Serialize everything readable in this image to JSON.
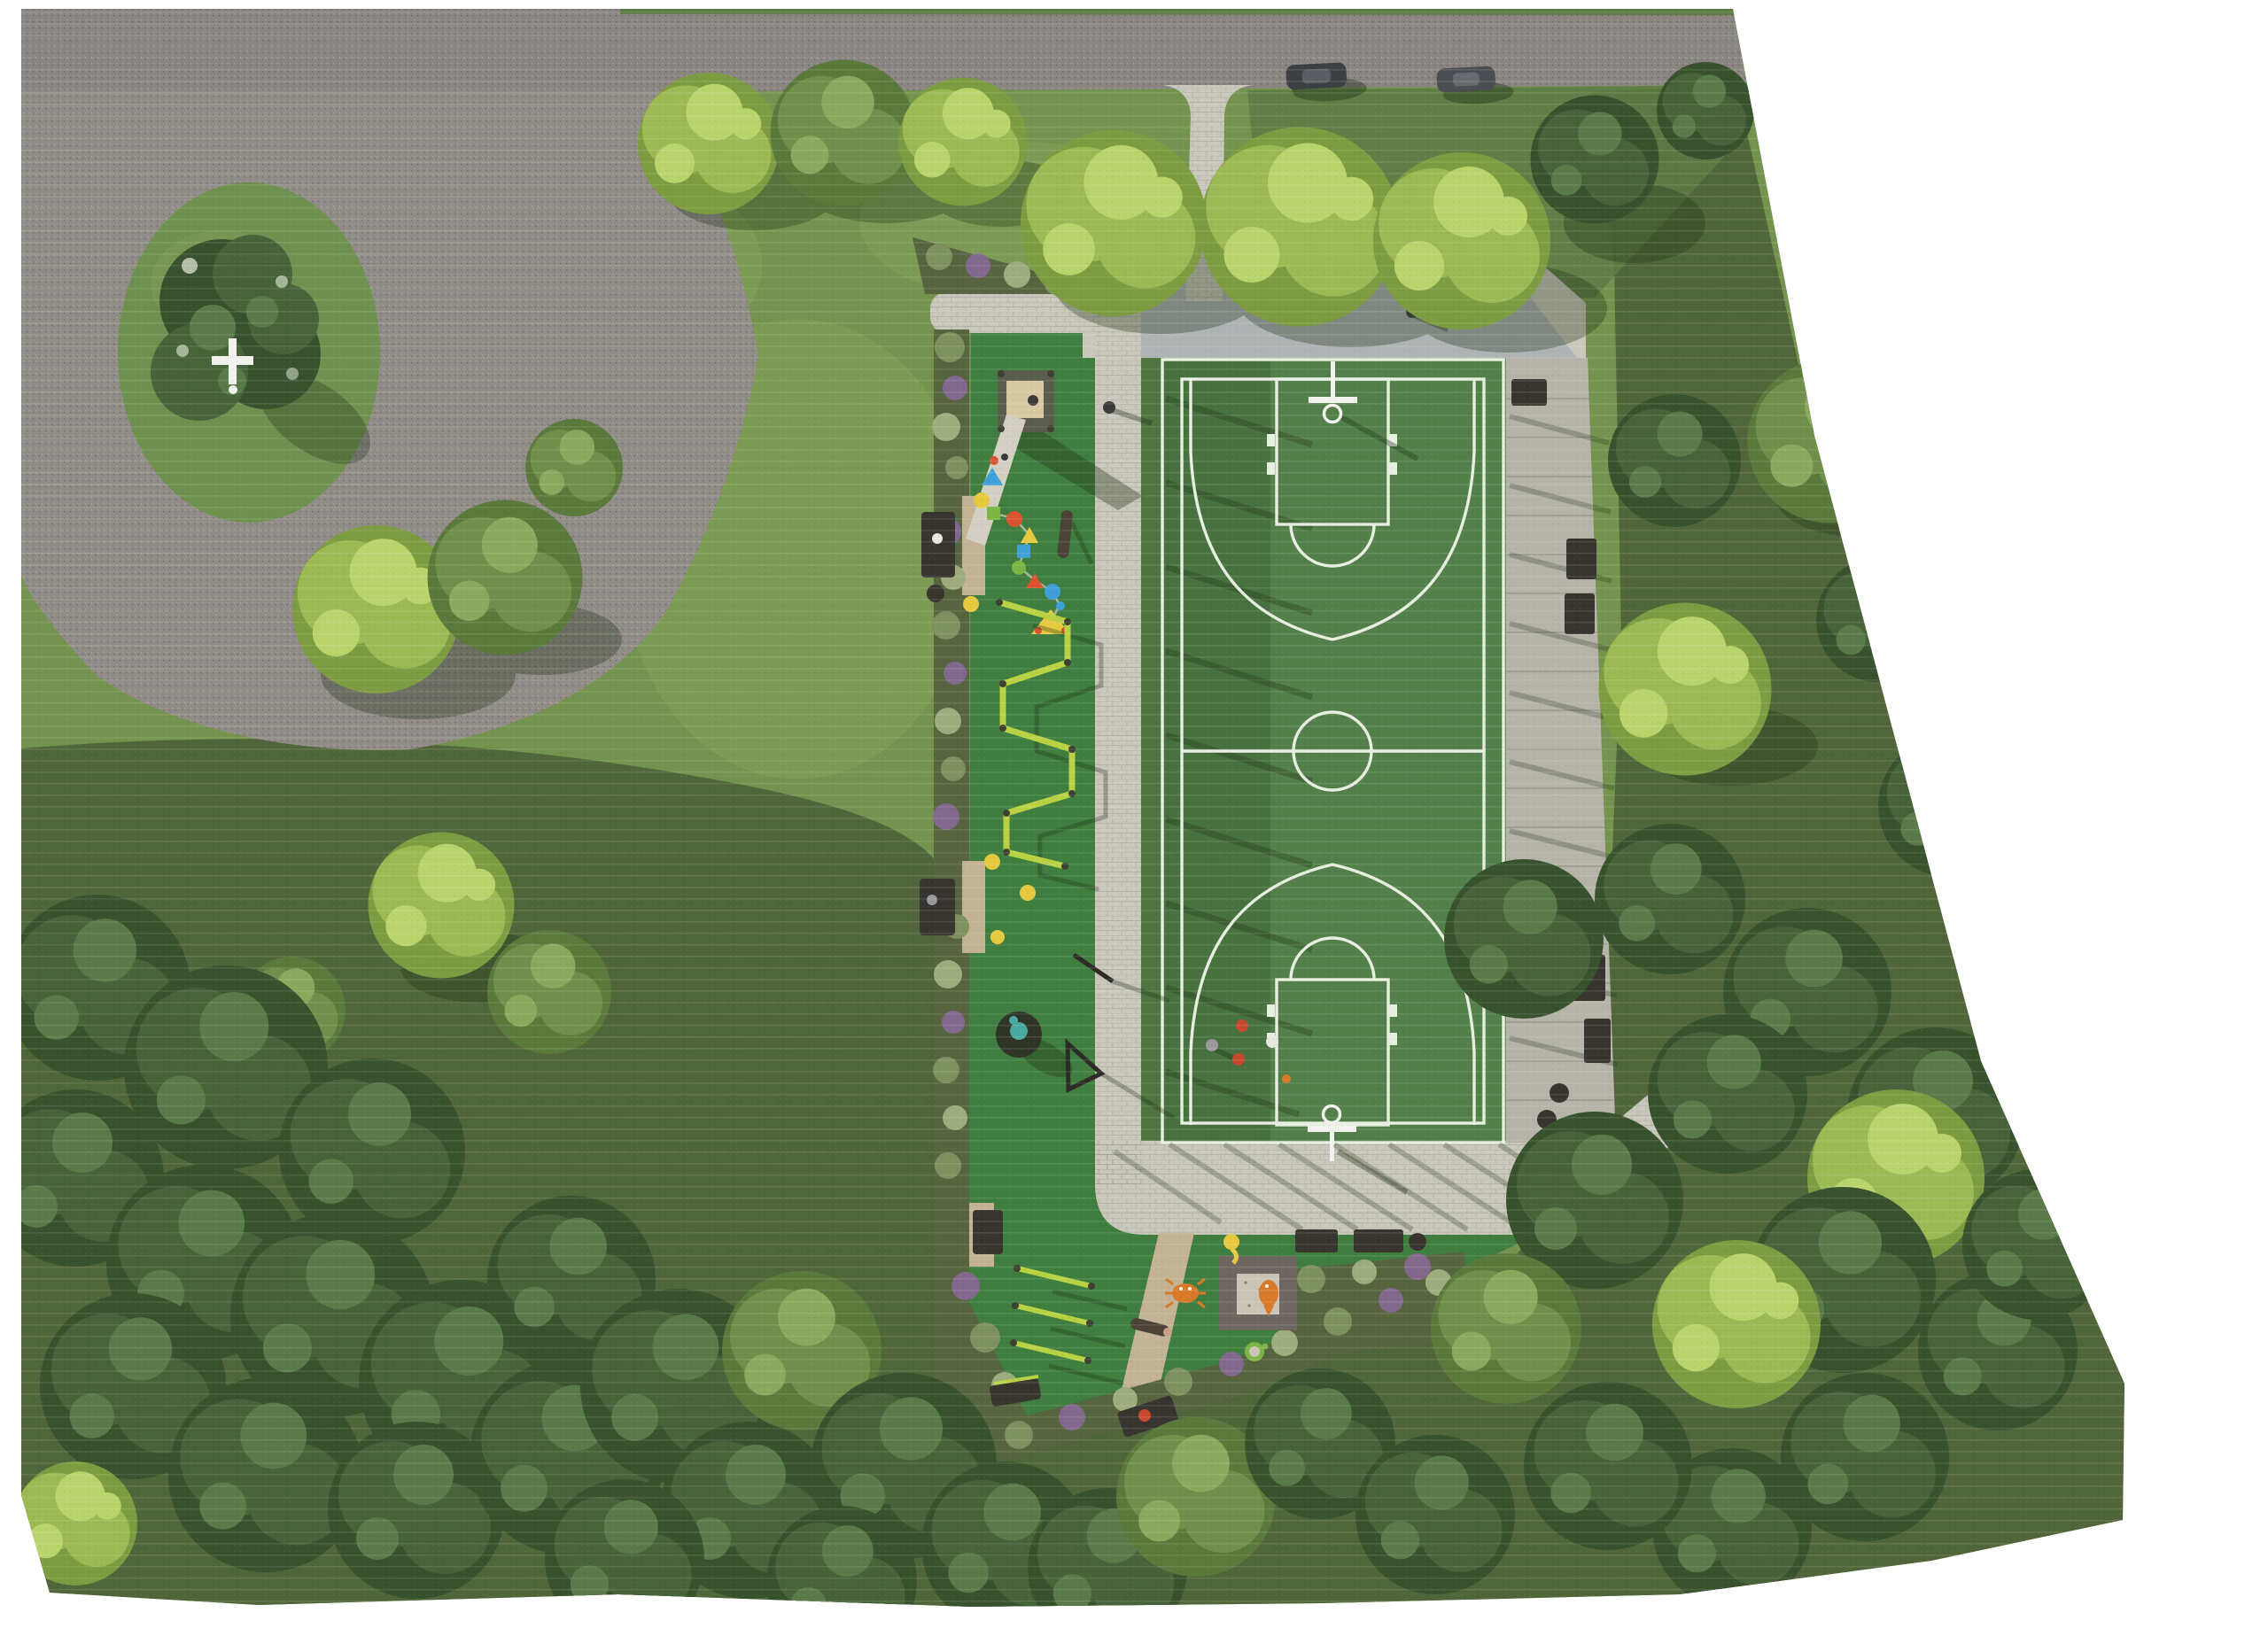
{
  "scene": {
    "type": "aerial-top-down-render",
    "subject": "park-site-plan",
    "elements": "road with cul-de-sac island, basketball court, playground, paths, woodland"
  },
  "features": {
    "road": {
      "label": "perimeter road",
      "cars_parked": 2
    },
    "cul_de_sac": {
      "label": "cul-de-sac with planted island",
      "center_marker": "white cross sculpture"
    },
    "basketball_court": {
      "label": "full basketball court",
      "hoops": 2,
      "players": 4,
      "balls": 1
    },
    "playground": {
      "label": "playground strip",
      "equipment": [
        "slide",
        "stepping-pod trail",
        "climbing frame",
        "spinner",
        "seesaw",
        "balance beam",
        "fitness bars",
        "sandbox"
      ],
      "ground_figures": [
        "seahorse",
        "crab",
        "fish",
        "turtle"
      ]
    },
    "furniture": {
      "benches": 11,
      "litter_bins": 4
    },
    "paths": {
      "entrance_from_road": 1,
      "court_walkways": 2
    },
    "vegetation": {
      "perimeter": "dense woodland",
      "planting_beds": "mixed shrub borders"
    }
  },
  "colors": {
    "white_bg": "#ffffff",
    "meadow": "#74934e",
    "meadow_light": "#84a35b",
    "rough": "#50663a",
    "rough_mid": "#5d7a44",
    "road": "#8a8581",
    "parking": "#918c88",
    "island": "#6f9150",
    "concrete": "#cac7bc",
    "plaza_shade": "#97a2ad",
    "walkway": "#b6b3a9",
    "play": "#3f7e3f",
    "gap_green": "#4e7440",
    "court": "#53804a",
    "court_shade": "#2f4a26",
    "court_line": "#e7efe1",
    "soil": "#56643f",
    "bed_green": "#7d905e",
    "bed_purple": "#81688c",
    "bed_light": "#9dac7c",
    "gravel": "#c3b294",
    "tree_b": "#9cb954",
    "tree_b_dk": "#7d9c41",
    "tree_b_hi": "#bad46c",
    "tree_m": "#6f8f4a",
    "tree_m_dk": "#5a7a3c",
    "tree_m_hi": "#8ba95d",
    "tree_d": "#46633a",
    "tree_d_dk": "#38522e",
    "tree_d_hi": "#597a49",
    "bench": "#38342f",
    "lime": "#b8d244",
    "slide_tan": "#d8c9a2",
    "ramp": "#d4cfc3",
    "sand_frame": "#6e6761",
    "sand": "#cac4b6",
    "marker": "#f2f2ee",
    "car": "#3c4044",
    "car2": "#4a4e52",
    "p_gray": "#9a9a9e",
    "p_red": "#c6492f",
    "p_white": "#e8e6e0",
    "ball": "#d97a2a",
    "pod_blue": "#3f9fd8",
    "pod_yellow": "#e7c93f",
    "pod_green": "#7cb544",
    "pod_red": "#d9542f",
    "teal": "#4aa9a2",
    "shadow": "#1f3015",
    "scan": "#fffff0"
  }
}
